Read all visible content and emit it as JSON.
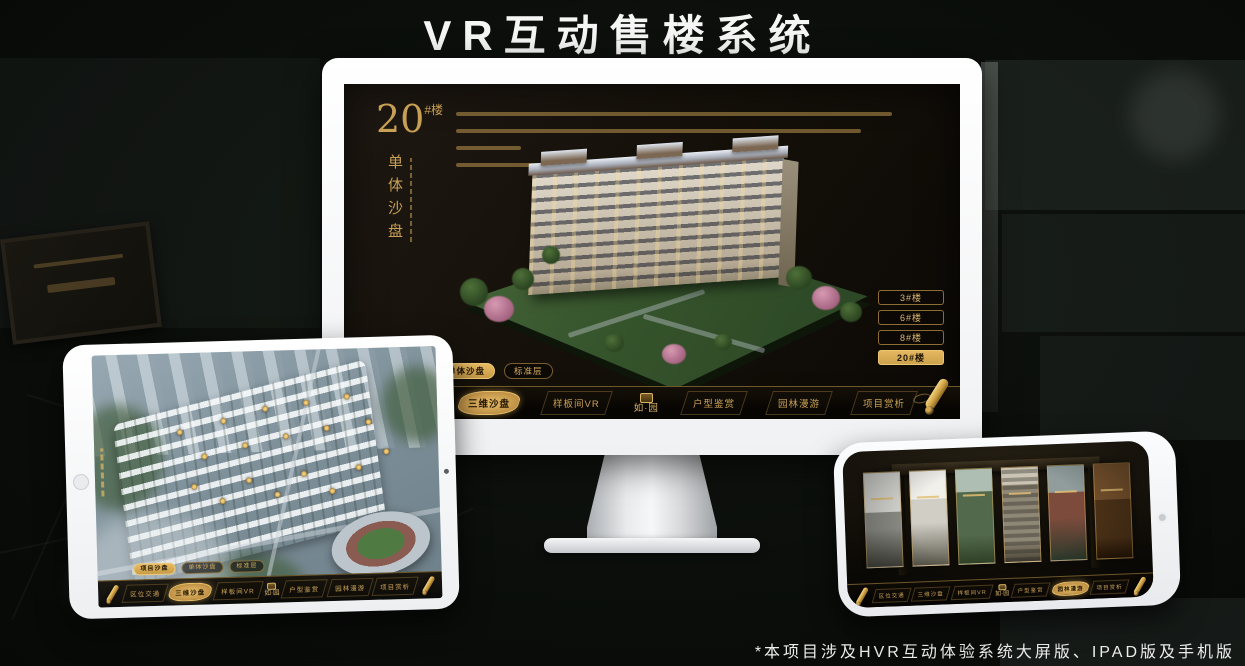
{
  "page": {
    "title": "VR互动售楼系统",
    "footnote": "*本项目涉及HVR互动体验系统大屏版、IPAD版及手机版"
  },
  "colors": {
    "gold": "#d4aa5e",
    "gold_active_bg": "#e8bb63",
    "screen_bg": "#141009"
  },
  "brand": {
    "logo_text": "如·园"
  },
  "labels": {
    "nav": [
      "区位交通",
      "三维沙盘",
      "样板间VR",
      "户型鉴赏",
      "园林漫游",
      "项目赏析"
    ],
    "sub_tabs": [
      "项目沙盘",
      "单体沙盘",
      "标准层"
    ],
    "floors": [
      "3#楼",
      "6#楼",
      "8#楼",
      "20#楼"
    ]
  },
  "desktop": {
    "heading_number": "20",
    "heading_unit": "#楼",
    "heading_vertical": "单体沙盘",
    "active_sub_tab": "单体沙盘",
    "active_nav": "三维沙盘",
    "active_floor": "20#楼"
  },
  "ipad": {
    "active_sub_tab": "项目沙盘",
    "active_nav": "三维沙盘"
  },
  "phone": {
    "active_nav": "园林漫游"
  }
}
